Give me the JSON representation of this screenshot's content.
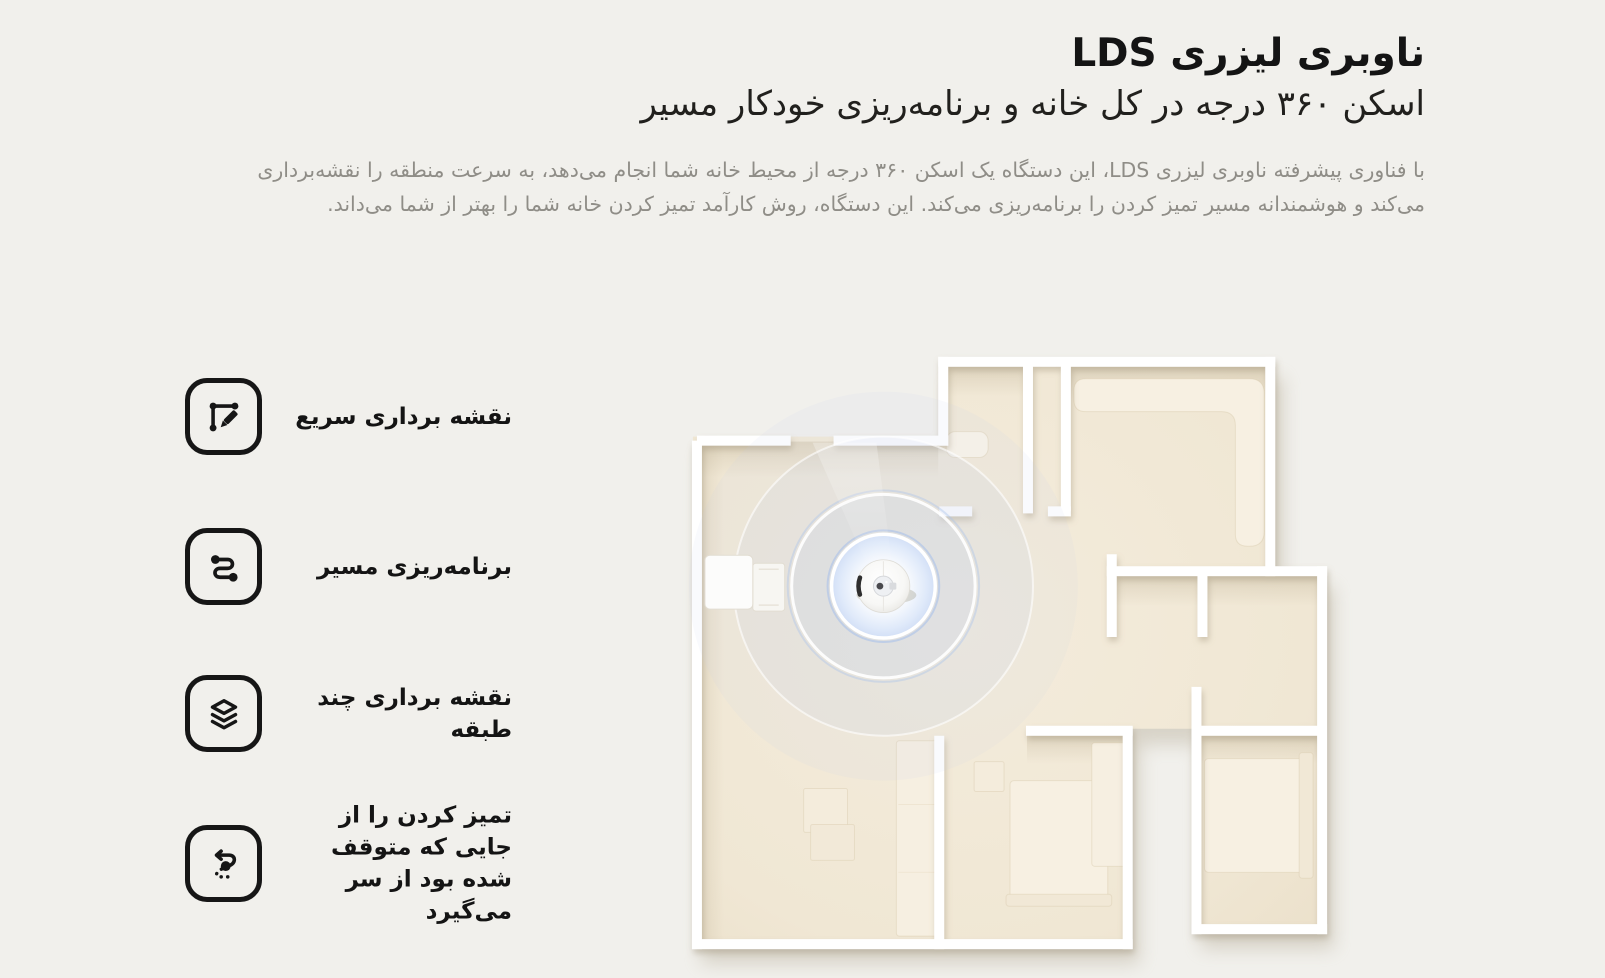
{
  "page": {
    "background": "#f1f0ec",
    "language": "fa",
    "direction": "rtl"
  },
  "header": {
    "title": "ناوبری لیزری LDS",
    "subtitle": "اسکن ۳۶۰ درجه در کل خانه و برنامه‌ریزی خودکار مسیر",
    "description": "با فناوری پیشرفته ناوبری لیزری LDS، این دستگاه یک اسکن ۳۶۰ درجه از محیط خانه شما انجام می‌دهد، به سرعت منطقه را نقشه‌برداری می‌کند و هوشمندانه مسیر تمیز کردن را برنامه‌ریزی می‌کند. این دستگاه، روش کارآمد تمیز کردن خانه شما را بهتر از شما می‌داند."
  },
  "features": [
    {
      "icon": "quick-mapping-icon",
      "label": "نقشه برداری سریع"
    },
    {
      "icon": "path-planning-icon",
      "label": "برنامه‌ریزی مسیر"
    },
    {
      "icon": "multi-floor-mapping-icon",
      "label": "نقشه برداری چند طبقه"
    },
    {
      "icon": "resume-cleaning-icon",
      "label": "تمیز کردن را از جایی که متوقف شده بود از سر می‌گیرد"
    }
  ],
  "illustration": {
    "name": "floor-plan-lidar-scan",
    "elements": [
      "floor-plan",
      "robot-vacuum",
      "lidar-scan-rings",
      "charging-dock",
      "furniture"
    ],
    "colors": {
      "floor_cream": "#f0e8d6",
      "wall_white": "#ffffff",
      "scan_blue": "#b9cdf0",
      "robot_body": "#fbfbfb"
    }
  },
  "colors": {
    "background": "#f1f0ec",
    "text_primary": "#141414",
    "text_secondary": "#8f8d87"
  }
}
